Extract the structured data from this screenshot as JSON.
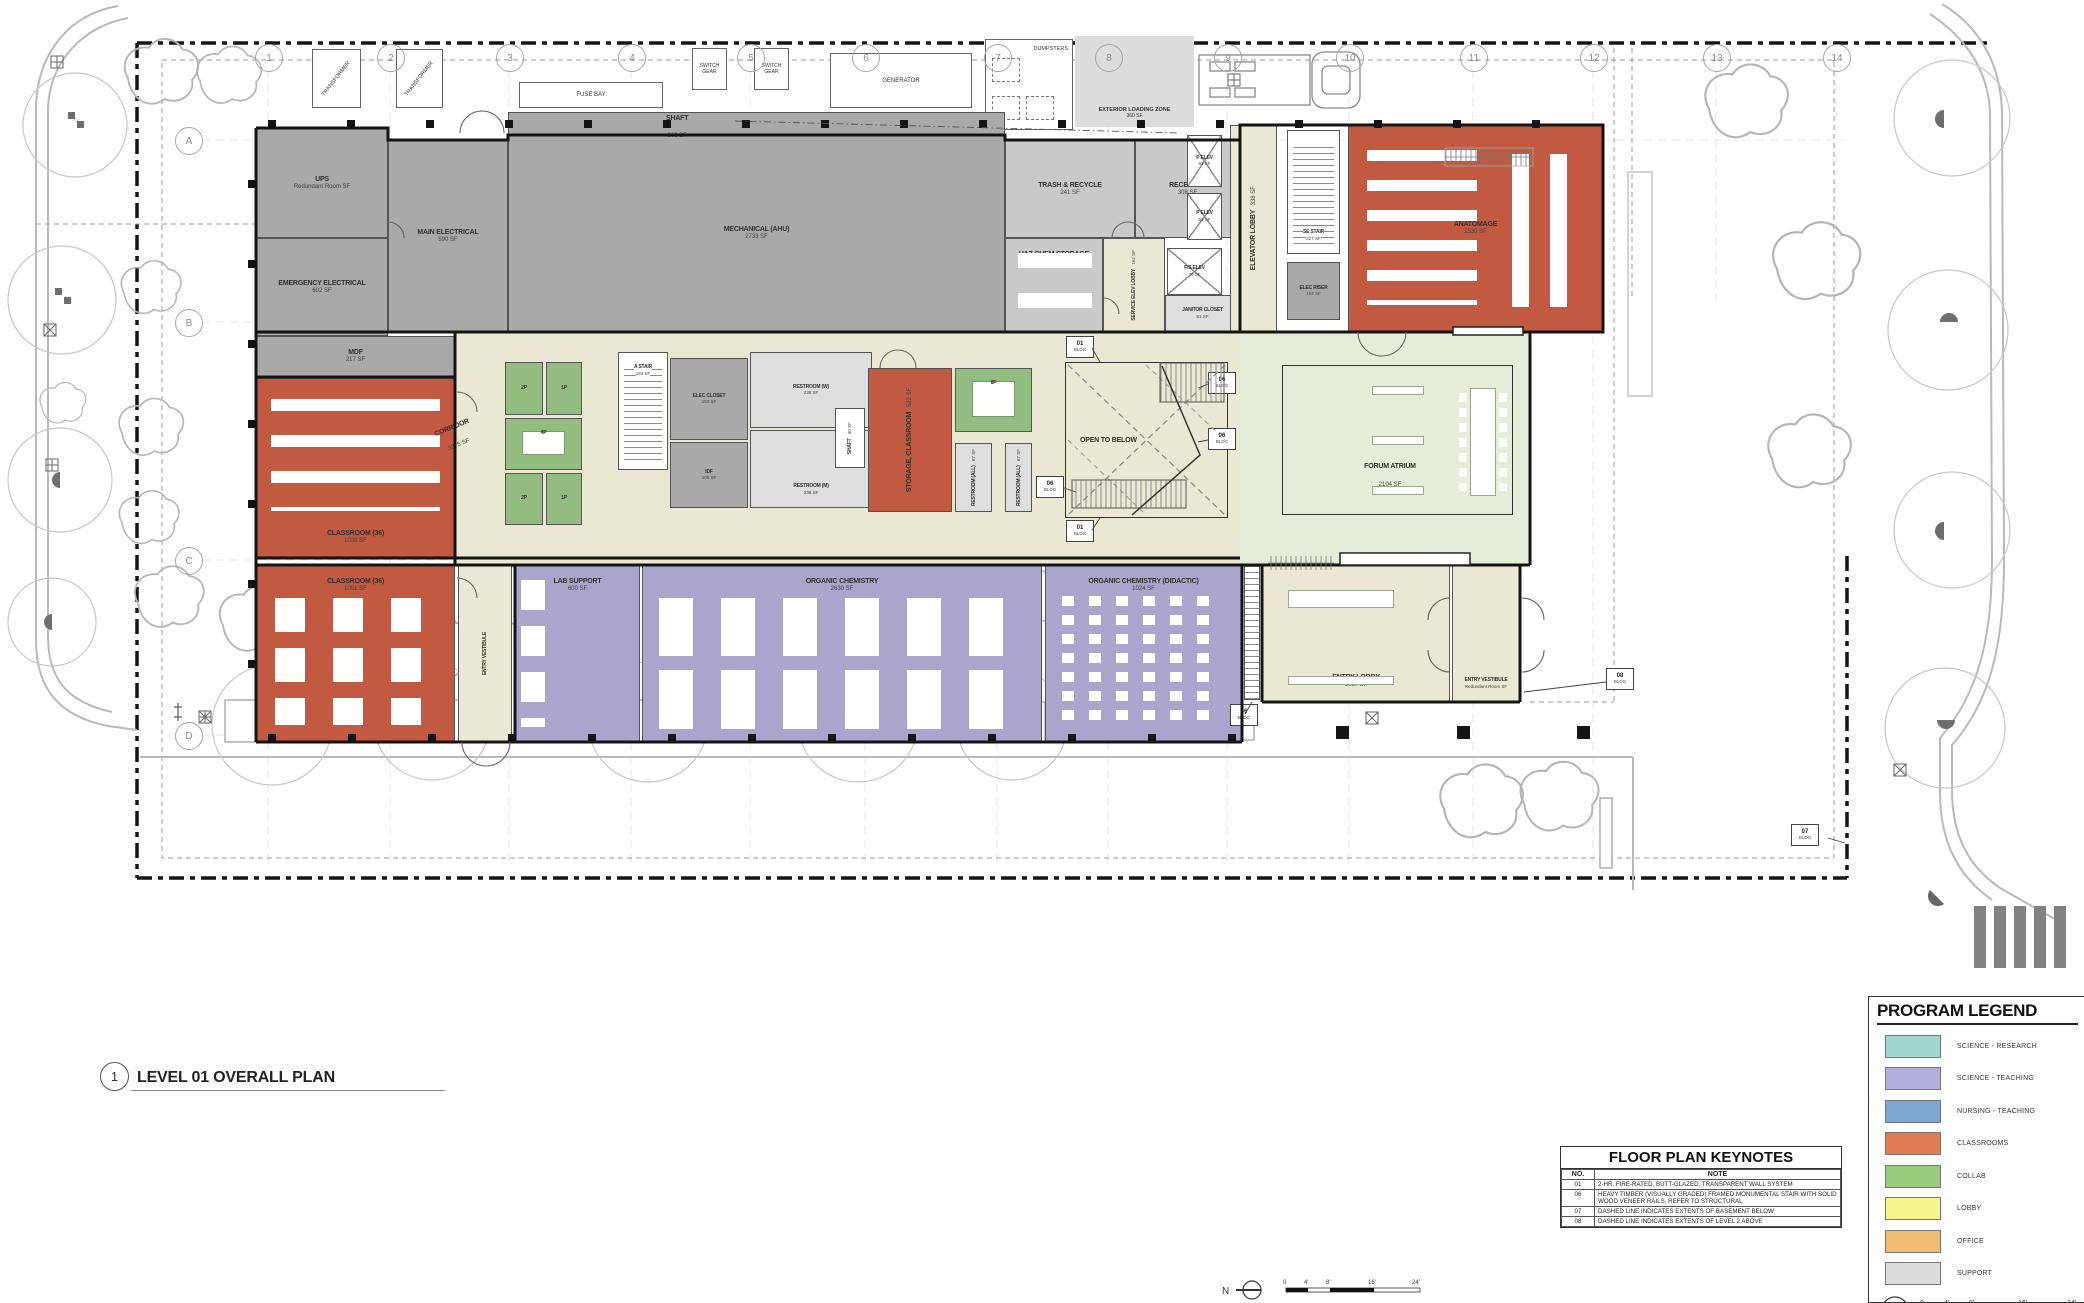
{
  "title_block": {
    "number": "1",
    "title": "LEVEL 01 OVERALL PLAN"
  },
  "north_label": "N",
  "scale_labels": [
    "0",
    "4'",
    "8'",
    "16'",
    "24'"
  ],
  "grid": {
    "columns": [
      "1",
      "2",
      "3",
      "4",
      "5",
      "6",
      "7",
      "8",
      "9",
      "10",
      "11",
      "12",
      "13",
      "14"
    ],
    "rows": [
      "A",
      "B",
      "C",
      "D"
    ]
  },
  "keynote_tags": {
    "k01": "01",
    "k06": "06",
    "k07": "07",
    "k08": "08",
    "sub": "BLDG"
  },
  "program_legend": {
    "title": "PROGRAM LEGEND",
    "items": [
      {
        "label": "SCIENCE - RESEARCH",
        "color": "#9fd6ce"
      },
      {
        "label": "SCIENCE - TEACHING",
        "color": "#b2afdc"
      },
      {
        "label": "NURSING - TEACHING",
        "color": "#7da6d4"
      },
      {
        "label": "CLASSROOMS",
        "color": "#de7e50"
      },
      {
        "label": "COLLAB",
        "color": "#9cca7d"
      },
      {
        "label": "LOBBY",
        "color": "#f6f48e"
      },
      {
        "label": "OFFICE",
        "color": "#f2bb72"
      },
      {
        "label": "SUPPORT",
        "color": "#dcdcdc"
      }
    ]
  },
  "keynotes": {
    "title": "FLOOR PLAN KEYNOTES",
    "col_no": "NO.",
    "col_note": "NOTE",
    "rows": [
      {
        "no": "01",
        "note": "2-HR. FIRE-RATED, BUTT-GLAZED, TRANSPARENT WALL SYSTEM"
      },
      {
        "no": "06",
        "note": "HEAVY TIMBER (VISUALLY GRADED) FRAMED MONUMENTAL STAIR WITH SOLID WOOD VENEER RAILS, REFER TO STRUCTURAL"
      },
      {
        "no": "07",
        "note": "DASHED LINE INDICATES EXTENTS OF BASEMENT BELOW"
      },
      {
        "no": "08",
        "note": "DASHED LINE INDICATES EXTENTS OF LEVEL 2 ABOVE"
      }
    ]
  },
  "site": {
    "transformer": "TRANSFORMER",
    "fuse_bay": "FUSE BAY",
    "switch_gear": "SWITCH GEAR",
    "generator": "GENERATOR",
    "dumpsters": "DUMPSTERS",
    "loading_zone": {
      "name": "EXTERIOR LOADING ZONE",
      "area": "360 SF"
    }
  },
  "rooms": {
    "ups": {
      "name": "UPS",
      "area": "Redundant Room SF"
    },
    "main_electrical": {
      "name": "MAIN ELECTRICAL",
      "area": "590 SF"
    },
    "emergency_electrical": {
      "name": "EMERGENCY ELECTRICAL",
      "area": "602 SF"
    },
    "mdf": {
      "name": "MDF",
      "area": "217 SF"
    },
    "mechanical": {
      "name": "MECHANICAL (AHU)",
      "area": "2733 SF"
    },
    "shaft_top": {
      "name": "SHAFT",
      "area": "306 SF"
    },
    "trash": {
      "name": "TRASH & RECYCLE",
      "area": "241 SF"
    },
    "receiving": {
      "name": "RECEIVING",
      "area": "308 SF"
    },
    "haz_chem": {
      "name": "HAZ CHEM STORAGE",
      "area": "554 SF"
    },
    "p_elev": {
      "name": "P ELEV",
      "area": "63 SF"
    },
    "fs_elev": {
      "name": "F/S ELEV",
      "area": "70 SF"
    },
    "service_elev_lobby": {
      "name": "SERVICE ELEV LOBBY",
      "area": "152 SF"
    },
    "janitor": {
      "name": "JANITOR CLOSET",
      "area": "61 SF"
    },
    "elevator_lobby": {
      "name": "ELEVATOR LOBBY",
      "area": "338 SF"
    },
    "se_stair": {
      "name": "SE STAIR",
      "area": "227 SF"
    },
    "elec_riser": {
      "name": "ELEC RISER",
      "area": "104 SF"
    },
    "anatomage": {
      "name": "ANATOMAGE",
      "area": "1530 SF"
    },
    "corridor": {
      "name": "CORRIDOR",
      "area": "3275 SF"
    },
    "a_stair": {
      "name": "A STAIR",
      "area": "184 SF"
    },
    "elec_closet": {
      "name": "ELEC CLOSET",
      "area": "153 SF"
    },
    "idf": {
      "name": "IDF",
      "area": "105 SF"
    },
    "restroom_w": {
      "name": "RESTROOM (W)",
      "area": "238 SF"
    },
    "restroom_m": {
      "name": "RESTROOM (M)",
      "area": "238 SF"
    },
    "shaft_core": {
      "name": "SHAFT",
      "area": "60 SF"
    },
    "storage_classroom": {
      "name": "STORAGE, CLASSROOM",
      "area": "522 SF"
    },
    "collab_2p": {
      "label": "2P"
    },
    "collab_1p": {
      "label": "1P"
    },
    "collab_4p": {
      "label": "4P"
    },
    "collab_8p": {
      "label": "8P"
    },
    "restroom_all": {
      "name": "RESTROOM (ALL)",
      "area": "67 SF"
    },
    "open_to_below": {
      "name": "OPEN TO BELOW"
    },
    "forum": {
      "name": "FORUM ATRIUM",
      "area": "2104 SF"
    },
    "classroom_a": {
      "name": "CLASSROOM (36)",
      "area": "1038 SF"
    },
    "classroom_b": {
      "name": "CLASSROOM (36)",
      "area": "1051 SF"
    },
    "entry_vestibule_l": {
      "name": "ENTRY VESTIBULE"
    },
    "lab_support": {
      "name": "LAB SUPPORT",
      "area": "600 SF"
    },
    "organic_chem": {
      "name": "ORGANIC CHEMISTRY",
      "area": "2630 SF"
    },
    "organic_didactic": {
      "name": "ORGANIC CHEMISTRY (DIDACTIC)",
      "area": "1024 SF"
    },
    "entry_lobby": {
      "name": "ENTRY LOBBY",
      "area": "1027 SF"
    },
    "entry_vestibule_r": {
      "name": "ENTRY VESTIBULE",
      "area": "Redundant Room SF"
    }
  }
}
